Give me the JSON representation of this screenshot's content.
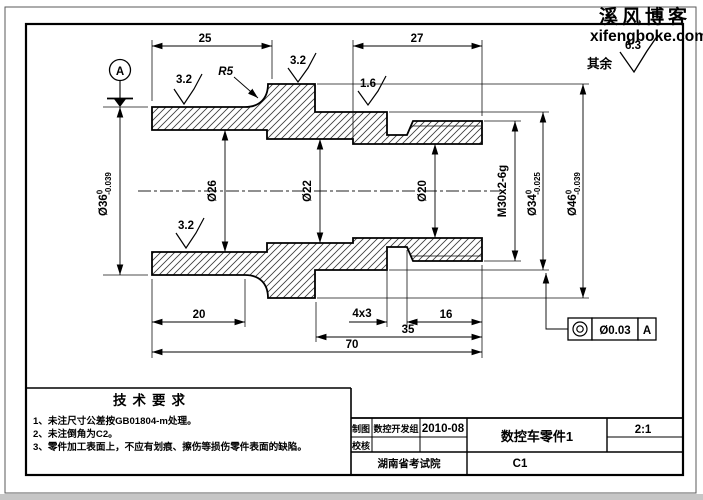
{
  "watermark": {
    "site_name": "溪风博客",
    "site_url": "xifengboke.com",
    "color": "#c01414"
  },
  "general_roughness": {
    "prefix": "其余",
    "value": "6.3"
  },
  "datum_label": "A",
  "dims": {
    "len25": "25",
    "len27": "27",
    "len20": "20",
    "groove": "4x3",
    "len16": "16",
    "len35": "35",
    "len70": "70",
    "fillet": "R5",
    "dia36_main": "Ø36",
    "dia36_up": "0",
    "dia36_low": "-0.039",
    "dia26": "Ø26",
    "dia22": "Ø22",
    "dia20": "Ø20",
    "thread": "M30x2-6g",
    "dia34_main": "Ø34",
    "dia34_up": "0",
    "dia34_low": "-0.025",
    "dia46_main": "Ø46",
    "dia46_up": "0",
    "dia46_low": "-0.039",
    "ra32": "3.2",
    "ra16": "1.6"
  },
  "fcf": {
    "symbol": "concentricity",
    "value": "Ø0.03",
    "datum": "A"
  },
  "tech_req": {
    "title": "技术要求",
    "items": [
      "1、未注尺寸公差按GB01804-m处理。",
      "2、未注倒角为C2。",
      "3、零件加工表面上，不应有划痕、擦伤等损伤零件表面的缺陷。"
    ]
  },
  "title_block": {
    "drawn_label": "制图",
    "drawn_by": "数控开发组",
    "date": "2010-08",
    "checked_label": "校核",
    "part_name": "数控车零件1",
    "scale": "2:1",
    "org": "湖南省考试院",
    "drawing_no": "C1"
  }
}
